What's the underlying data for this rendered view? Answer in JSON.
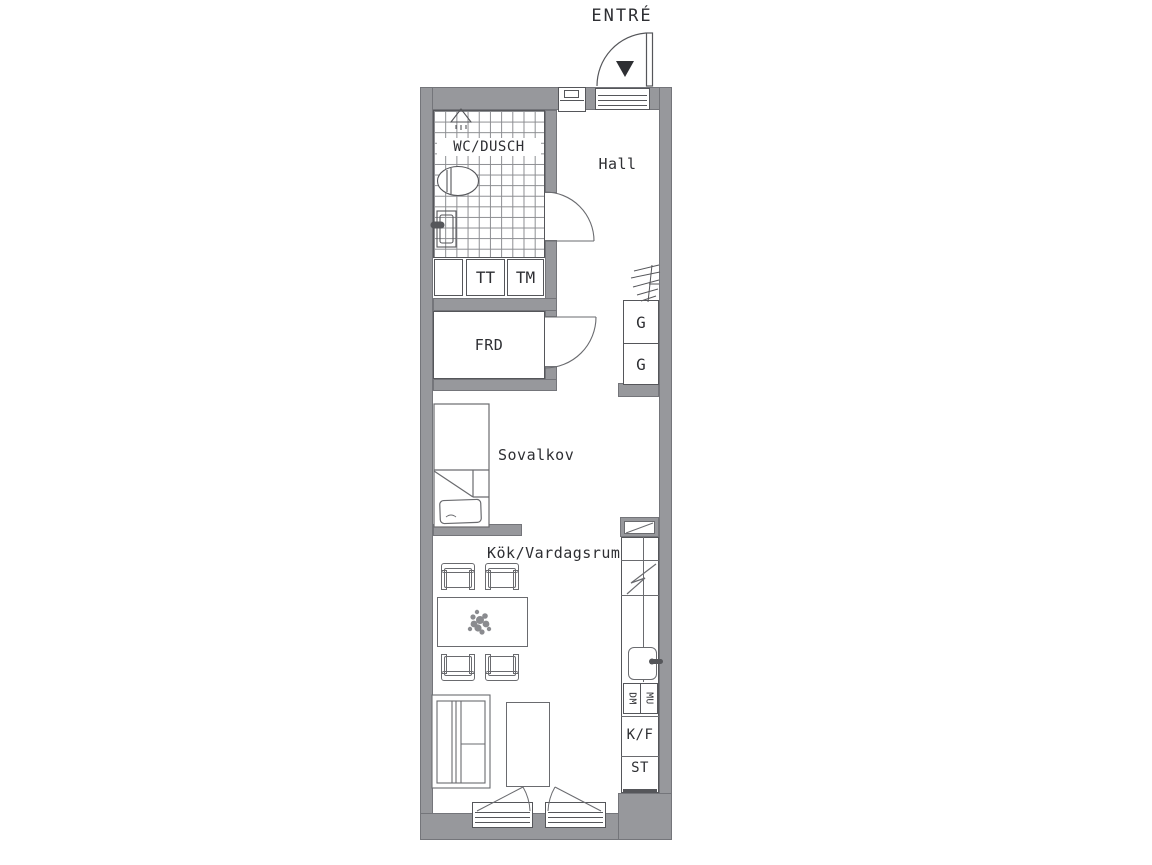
{
  "plan": {
    "entrance": "ENTRÉ",
    "rooms": {
      "bathroom": "WC/DUSCH",
      "hall": "Hall",
      "storage": "FRD",
      "sleeping_alcove": "Sovalkov",
      "kitchen_living": "Kök/Vardagsrum"
    },
    "fixtures": {
      "dryer": "TT",
      "washing_machine": "TM",
      "wardrobe_1": "G",
      "wardrobe_2": "G",
      "dishwasher": "DM",
      "microwave": "MU",
      "fridge_freezer": "K/F",
      "cleaning_cabinet": "ST"
    },
    "icons": {
      "entrance_marker": "filled-triangle-down",
      "entrance_door": "quarter-circle-swing",
      "shower": "shower-head",
      "toilet": "toilet-oval",
      "washbasin": "basin-with-tap",
      "coat_rail": "hanger-rail",
      "bed": "single-bed-with-pillow",
      "plant": "table-plant",
      "stove": "zigzag-symbol",
      "kitchen_sink": "sink-with-tap",
      "sofa": "sofa-top-view",
      "balcony_doors": "double-inward-swing"
    },
    "colors": {
      "wall": "#97989c",
      "wall_edge": "#74757a",
      "line": "#55565a",
      "furniture_line": "#6a6b6f",
      "text": "#2e2f33",
      "background": "#ffffff"
    }
  }
}
